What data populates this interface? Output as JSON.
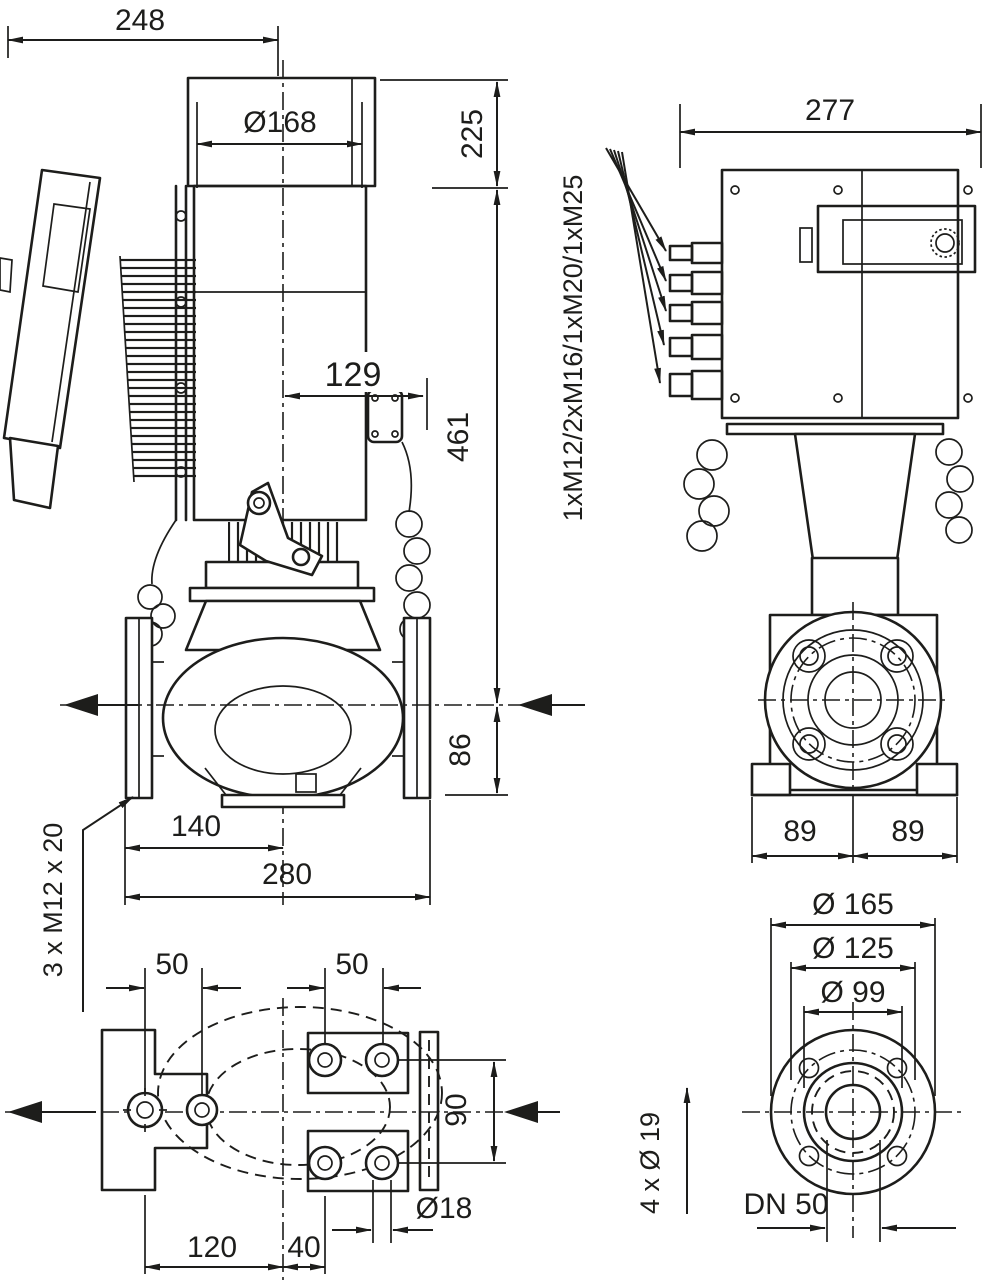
{
  "drawing": {
    "background": "#ffffff",
    "line_color": "#1d1d1b",
    "front_view": {
      "dim_overall_width": "248",
      "dim_motor_diameter": "Ø168",
      "dim_height_top": "225",
      "dim_module_offset": "129",
      "dim_height_axis_to_top": "461",
      "dim_height_axis_to_base": "86",
      "dim_flange_to_center": "140",
      "dim_flange_to_flange": "280",
      "label_base_bolts": "3 x M12 x 20"
    },
    "side_view": {
      "dim_overall_depth": "277",
      "label_cable_glands": "1xM12/2xM16/1xM20/1xM25",
      "dim_flange_half_left": "89",
      "dim_flange_half_right": "89"
    },
    "foot_view": {
      "dim_bolt_spacing_left": "50",
      "dim_bolt_spacing_right": "50",
      "dim_bolt_spacing_vertical": "90",
      "dim_foot_hole_diameter": "Ø18",
      "dim_bolt_to_center": "120",
      "dim_center_to_bolt": "40"
    },
    "flange_view": {
      "dim_flange_outer_diameter": "Ø 165",
      "dim_bolt_circle_diameter": "Ø 125",
      "dim_raised_face_diameter": "Ø 99",
      "label_bolt_holes": "4 x Ø 19",
      "label_nominal_diameter": "DN 50"
    }
  }
}
